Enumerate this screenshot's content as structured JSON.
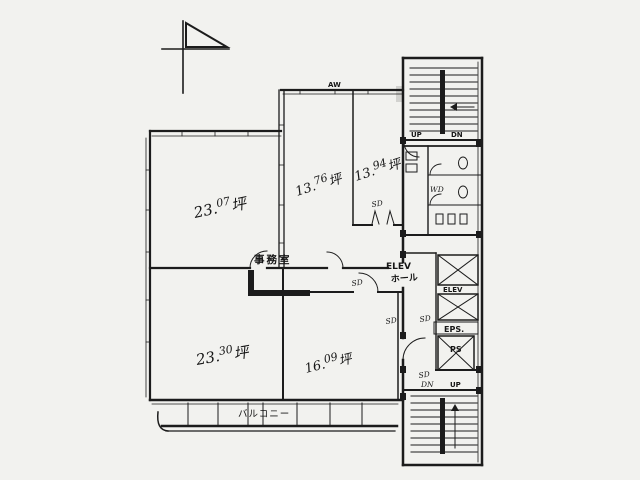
{
  "colors": {
    "ink": "#1c1c1c",
    "paper": "#f2f2ef"
  },
  "rooms": [
    {
      "id": "upper-left",
      "int": "23.",
      "dec": "07",
      "unit": "坪"
    },
    {
      "id": "upper-middle",
      "int": "13.",
      "dec": "76",
      "unit": "坪"
    },
    {
      "id": "upper-right",
      "int": "13.",
      "dec": "94",
      "unit": "坪"
    },
    {
      "id": "lower-left",
      "int": "23.",
      "dec": "30",
      "unit": "坪"
    },
    {
      "id": "lower-middle",
      "int": "16.",
      "dec": "09",
      "unit": "坪"
    }
  ],
  "labels": {
    "office": "事務室",
    "balcony": "バルコニー",
    "aw": "AW",
    "elev_hall_line1": "ELEV",
    "elev_hall_line2": "ホール",
    "elev_shaft": "ELEV",
    "eps": "EPS.",
    "ps": "PS",
    "wd": "WD",
    "up_top": "UP",
    "dn_top": "DN",
    "up_bottom": "UP",
    "dn_bottom": "DN",
    "sd_vestibule": "SD",
    "sd_corridor": "SD",
    "sd_hall": "SD",
    "sd_core_upper": "SD",
    "sd_core_lower": "SD"
  }
}
